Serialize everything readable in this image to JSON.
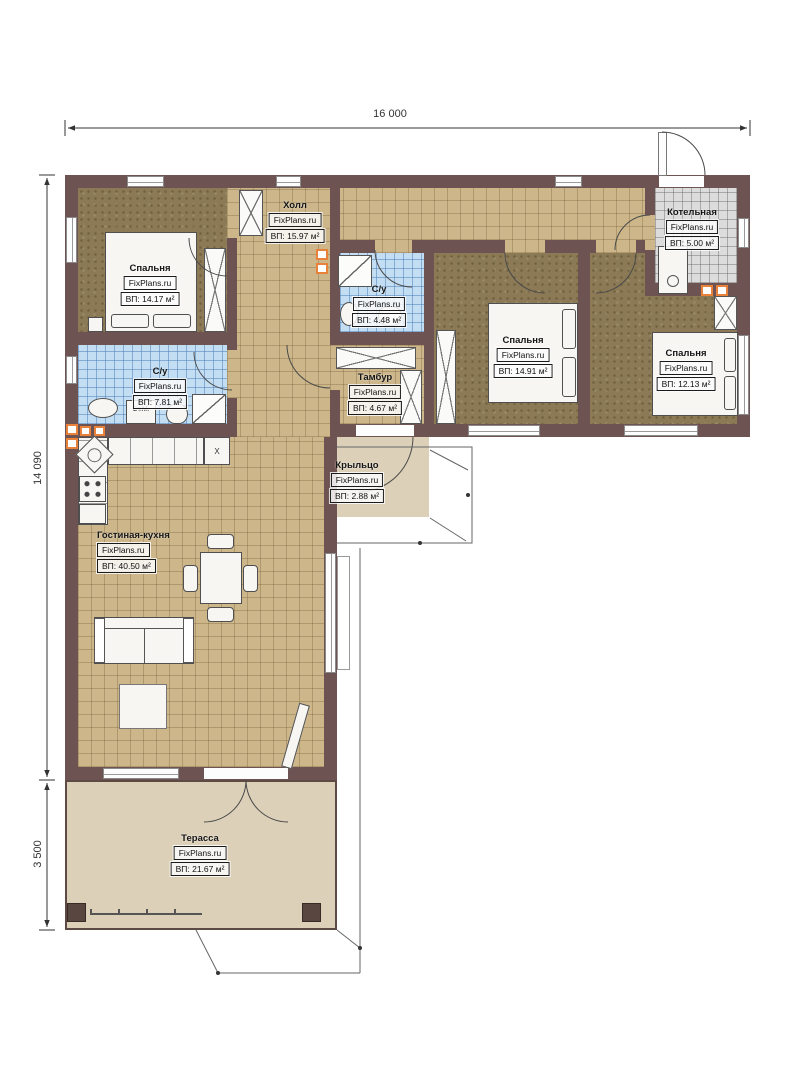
{
  "plan": {
    "title": "Floor plan",
    "brand": "FixPlans.ru",
    "dimensions": {
      "width_top": "16 000",
      "height_left": "14 090",
      "terrace_height_left": "3 500"
    },
    "rooms": [
      {
        "key": "hall",
        "name": "Холл",
        "brand": "FixPlans.ru",
        "area": "ВП: 15.97 м²"
      },
      {
        "key": "bedroom1",
        "name": "Спальня",
        "brand": "FixPlans.ru",
        "area": "ВП: 14.17 м²"
      },
      {
        "key": "bath1",
        "name": "С/у",
        "brand": "FixPlans.ru",
        "area": "ВП: 7.81 м²"
      },
      {
        "key": "bath2",
        "name": "С/у",
        "brand": "FixPlans.ru",
        "area": "ВП: 4.48 м²"
      },
      {
        "key": "tambur",
        "name": "Тамбур",
        "brand": "FixPlans.ru",
        "area": "ВП: 4.67 м²"
      },
      {
        "key": "bedroom2",
        "name": "Спальня",
        "brand": "FixPlans.ru",
        "area": "ВП: 14.91 м²"
      },
      {
        "key": "bedroom3",
        "name": "Спальня",
        "brand": "FixPlans.ru",
        "area": "ВП: 12.13 м²"
      },
      {
        "key": "boiler",
        "name": "Котельная",
        "brand": "FixPlans.ru",
        "area": "ВП: 5.00 м²"
      },
      {
        "key": "living",
        "name": "Гостиная-кухня",
        "brand": "FixPlans.ru",
        "area": "ВП: 40.50 м²"
      },
      {
        "key": "porch",
        "name": "Крыльцо",
        "brand": "FixPlans.ru",
        "area": "ВП: 2.88 м²"
      },
      {
        "key": "terrace",
        "name": "Терасса",
        "brand": "FixPlans.ru",
        "area": "ВП: 21.67 м²"
      }
    ],
    "annotations": {
      "washer": "Ст.М.",
      "counter_x": "X"
    },
    "colors": {
      "wall": "#6d5452",
      "tile_tan": "#ccb68a",
      "tile_blue": "#c3ddf2",
      "tile_gray": "#dcdcdc",
      "floor_brown": "#8b7a55",
      "outdoor": "#ddd0b8",
      "vent_orange": "#e8813a"
    }
  }
}
